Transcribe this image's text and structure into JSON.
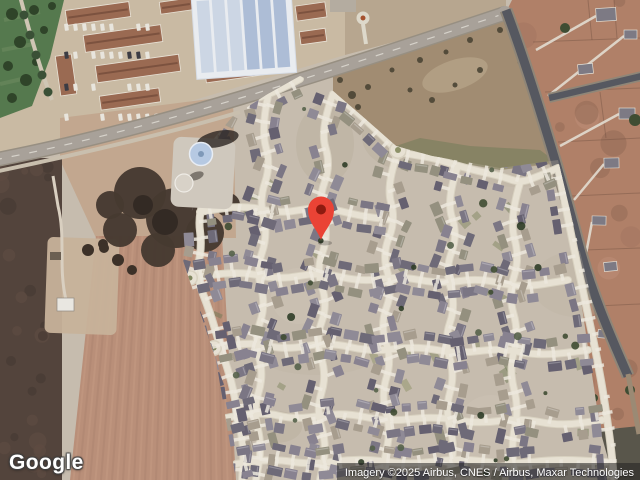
{
  "map": {
    "mode": "satellite",
    "marker": {
      "x": 321,
      "y": 241,
      "color": "#EA4335",
      "dot_color": "#8E1B10"
    },
    "google_logo": "Google",
    "attribution": "Imagery ©2025 Airbus, CNES / Airbus, Maxar Technologies"
  },
  "scene": {
    "label": "aerial view: residential subdivision with curving streets, plowed field west, apartment complex and industrial roof north, water tower, rural lots east",
    "colors": {
      "ground": "#c6bcae",
      "nw_ground": "#c9baa3",
      "n_strip": "#b7a68f",
      "west_dirt": "#c2a78f",
      "street_edge": "#d8d1c0",
      "street": "#e7e1d3",
      "driveway": "#ece8dd",
      "roof_palette": [
        "#6e6a78",
        "#7b7684",
        "#888290",
        "#656070",
        "#94907f",
        "#8f8a96",
        "#a79d8e"
      ],
      "lawn": [
        "#7f855f",
        "#8d9168",
        "#6f7a55"
      ],
      "tree": [
        "#3f4d33",
        "#55624a",
        "#2f3d28"
      ],
      "main_road": "#a8a199",
      "road_shoulder": "#978f82",
      "road_dash": "#d6d2ca",
      "dark_road": "#565860",
      "dark_shoulder": "#8f8678",
      "field": "#b98f79",
      "stripe_a": "#c59c84",
      "stripe_b": "#ac8470",
      "scrub": "#53443c",
      "park": "#55794e",
      "apartment_roof": "#9a6a52",
      "apartment_ridge": "#7c523f",
      "industrial_base": "#e9ecf0",
      "panel_light": "#ccd6e4",
      "panel_dark": "#adbdd6",
      "open_field": "#a18c72",
      "rural_dirt": "#b08068",
      "pond": "#463a31",
      "water_tower": "#b6c9e2",
      "tank": "#d8d2c8",
      "dark_corner": "#59564b"
    }
  }
}
